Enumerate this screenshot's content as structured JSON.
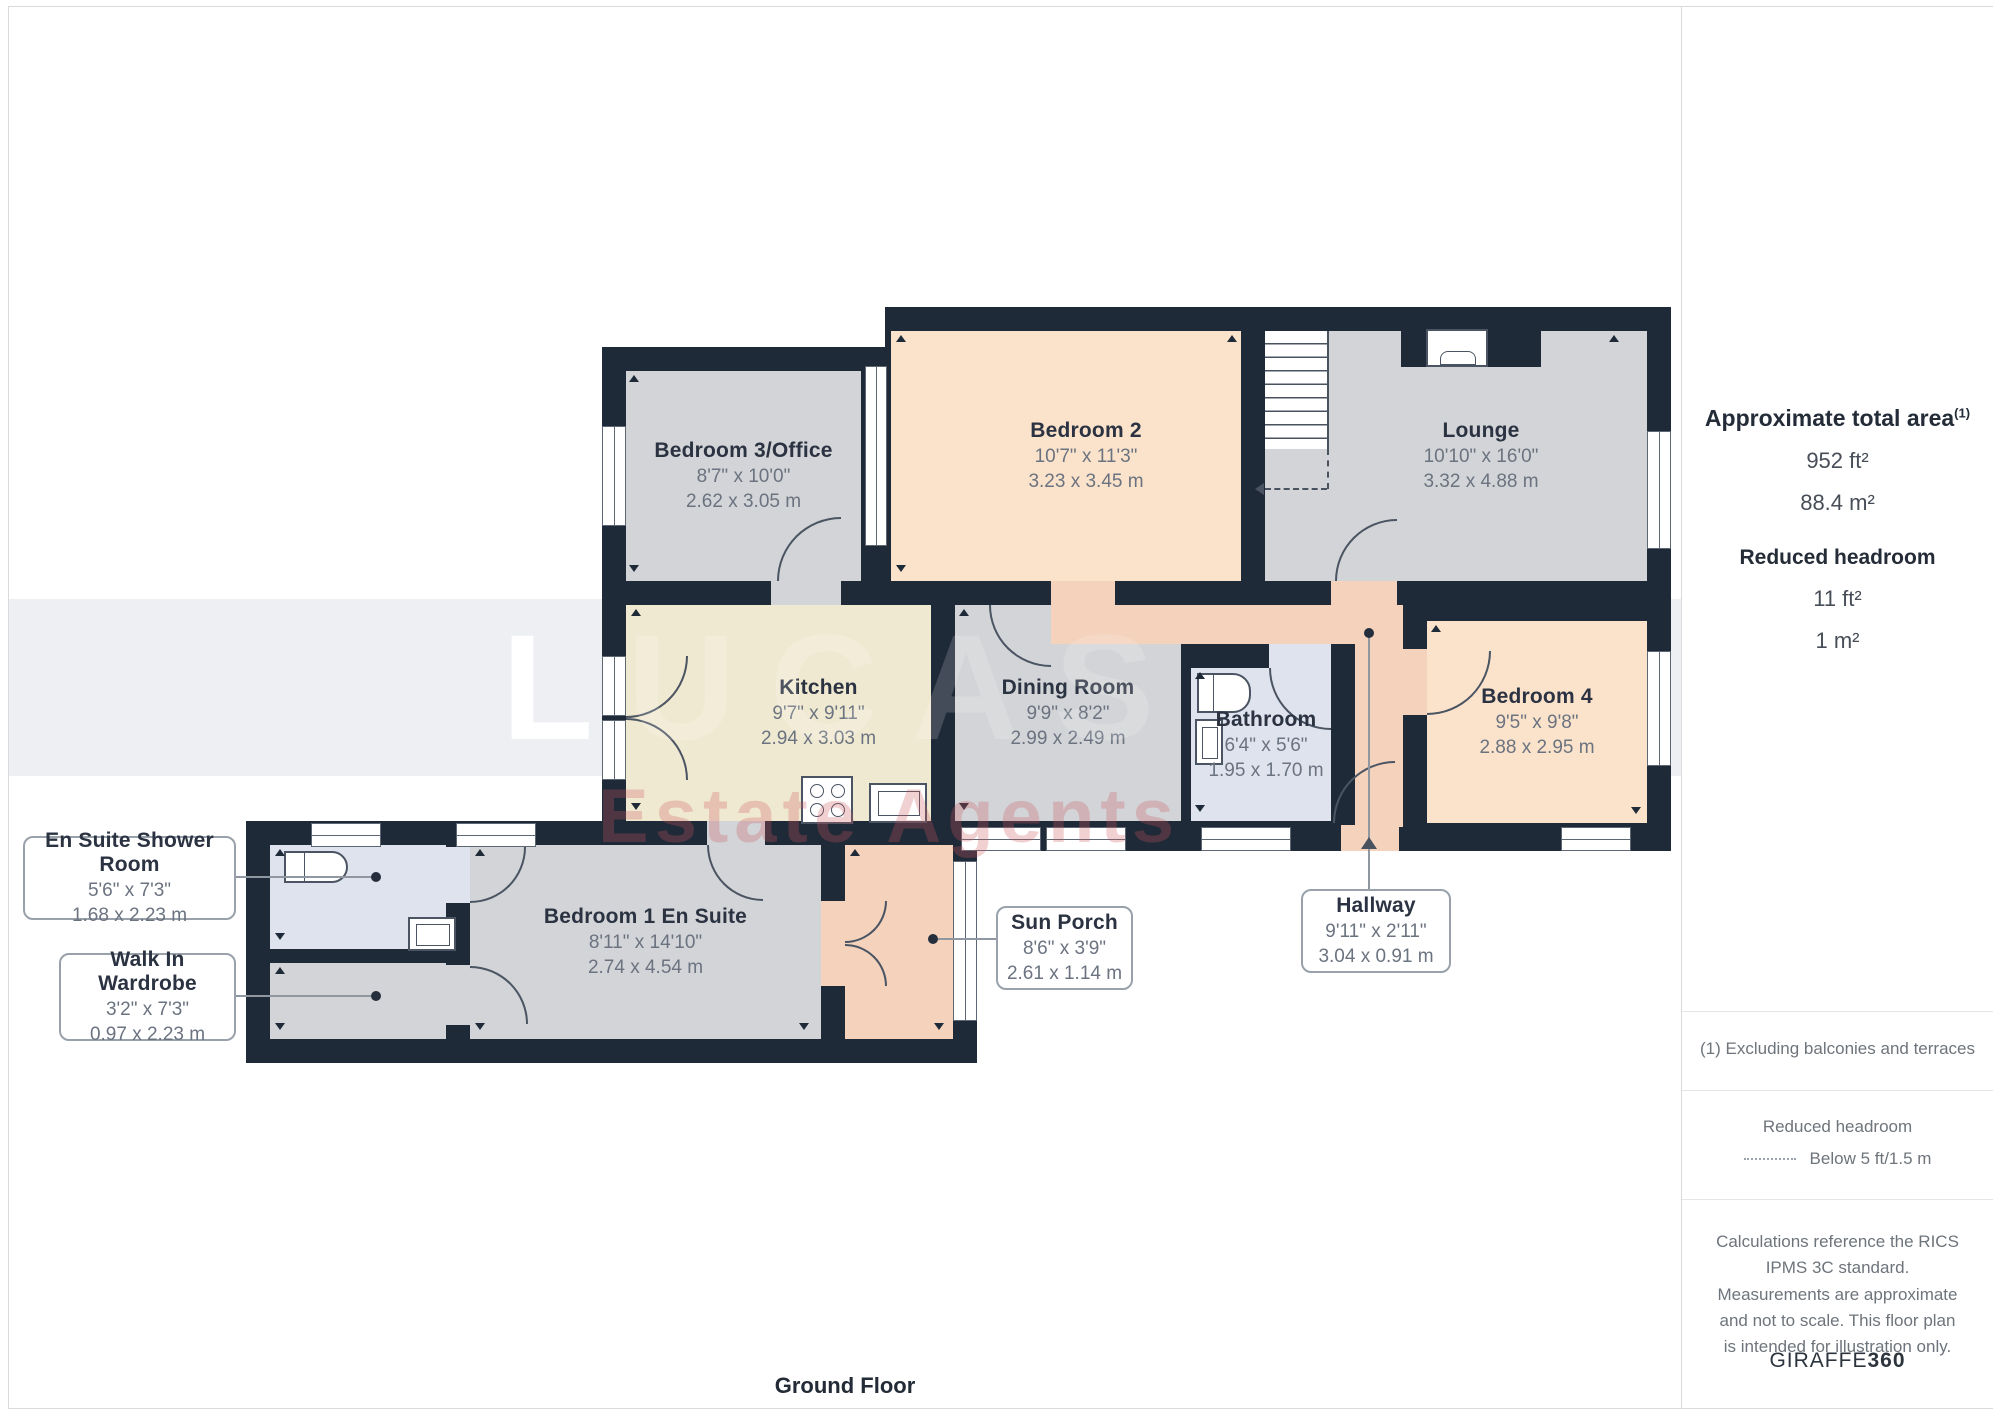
{
  "floorplan": {
    "title": "Ground Floor",
    "watermark": {
      "line1": "LUCAS",
      "line2": "Estate Agents"
    },
    "palette": {
      "wall": "#1f2a38",
      "room_gray": "#d2d4d7",
      "room_peach": "#fbe3cb",
      "room_cream": "#f0e9d1",
      "room_blue": "#dfe3ee",
      "room_salmon": "#f4d2bc",
      "label_name": "#2b3342",
      "label_dims": "#6b7380"
    },
    "rooms": [
      {
        "id": "bedroom3",
        "name": "Bedroom 3/Office",
        "imperial": "8'7\" x 10'0\"",
        "metric": "2.62 x 3.05 m"
      },
      {
        "id": "bedroom2",
        "name": "Bedroom 2",
        "imperial": "10'7\" x 11'3\"",
        "metric": "3.23 x 3.45 m"
      },
      {
        "id": "lounge",
        "name": "Lounge",
        "imperial": "10'10\" x 16'0\"",
        "metric": "3.32 x 4.88 m"
      },
      {
        "id": "kitchen",
        "name": "Kitchen",
        "imperial": "9'7\" x 9'11\"",
        "metric": "2.94 x 3.03 m"
      },
      {
        "id": "dining",
        "name": "Dining Room",
        "imperial": "9'9\" x 8'2\"",
        "metric": "2.99 x 2.49 m"
      },
      {
        "id": "bathroom",
        "name": "Bathroom",
        "imperial": "6'4\" x 5'6\"",
        "metric": "1.95 x 1.70 m"
      },
      {
        "id": "bedroom4",
        "name": "Bedroom 4",
        "imperial": "9'5\" x 9'8\"",
        "metric": "2.88 x 2.95 m"
      },
      {
        "id": "bedroom1",
        "name": "Bedroom 1 En Suite",
        "imperial": "8'11\" x 14'10\"",
        "metric": "2.74 x 4.54 m"
      }
    ],
    "callouts": [
      {
        "id": "ensuite-shower-room",
        "name": "En Suite Shower Room",
        "imperial": "5'6\" x 7'3\"",
        "metric": "1.68 x 2.23 m"
      },
      {
        "id": "walk-in-wardrobe",
        "name": "Walk In Wardrobe",
        "imperial": "3'2\" x 7'3\"",
        "metric": "0.97 x 2.23 m"
      },
      {
        "id": "sun-porch",
        "name": "Sun Porch",
        "imperial": "8'6\" x 3'9\"",
        "metric": "2.61 x 1.14 m"
      },
      {
        "id": "hallway",
        "name": "Hallway",
        "imperial": "9'11\" x 2'11\"",
        "metric": "3.04 x 0.91 m"
      }
    ]
  },
  "sidebar": {
    "total_area_title": "Approximate total area",
    "total_area_footnote_ref": "(1)",
    "total_area_ft": "952 ft²",
    "total_area_m": "88.4 m²",
    "reduced_headroom_title": "Reduced headroom",
    "reduced_headroom_ft": "11 ft²",
    "reduced_headroom_m": "1 m²",
    "footnote": "(1) Excluding balconies and terraces",
    "legend_title": "Reduced headroom",
    "legend_label": "Below 5 ft/1.5 m",
    "disclaimer": "Calculations reference the RICS IPMS 3C standard. Measurements are approximate and not to scale. This floor plan is intended for illustration only.",
    "brand_name": "GIRAFFE",
    "brand_number": "360"
  }
}
